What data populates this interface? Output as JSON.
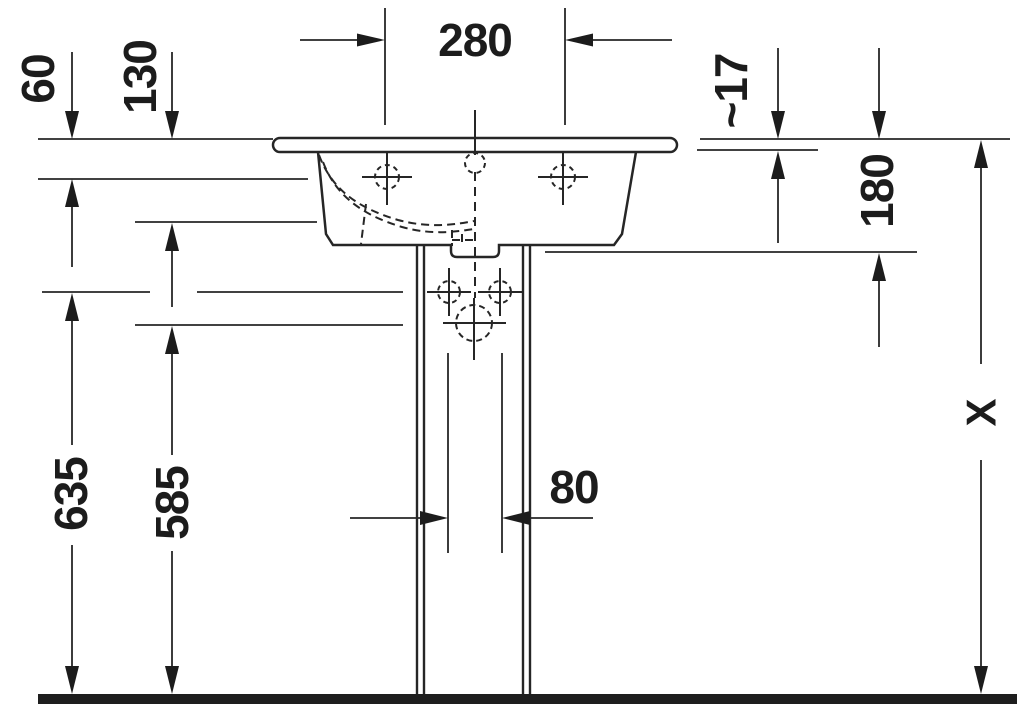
{
  "page": {
    "background": "#ffffff",
    "line_color": "#262626",
    "text_color": "#1c1c1c"
  },
  "drawing": {
    "title": "pedestal washbasin front elevation technical drawing",
    "units": "mm",
    "labels": {
      "tap_spacing": "280",
      "rim_to_overflow": "60",
      "rim_to_deck": "130",
      "rim_thickness": "~17",
      "basin_depth": "180",
      "supply_height": "635",
      "waste_height": "585",
      "drain_width": "80",
      "total_height": "X"
    }
  }
}
